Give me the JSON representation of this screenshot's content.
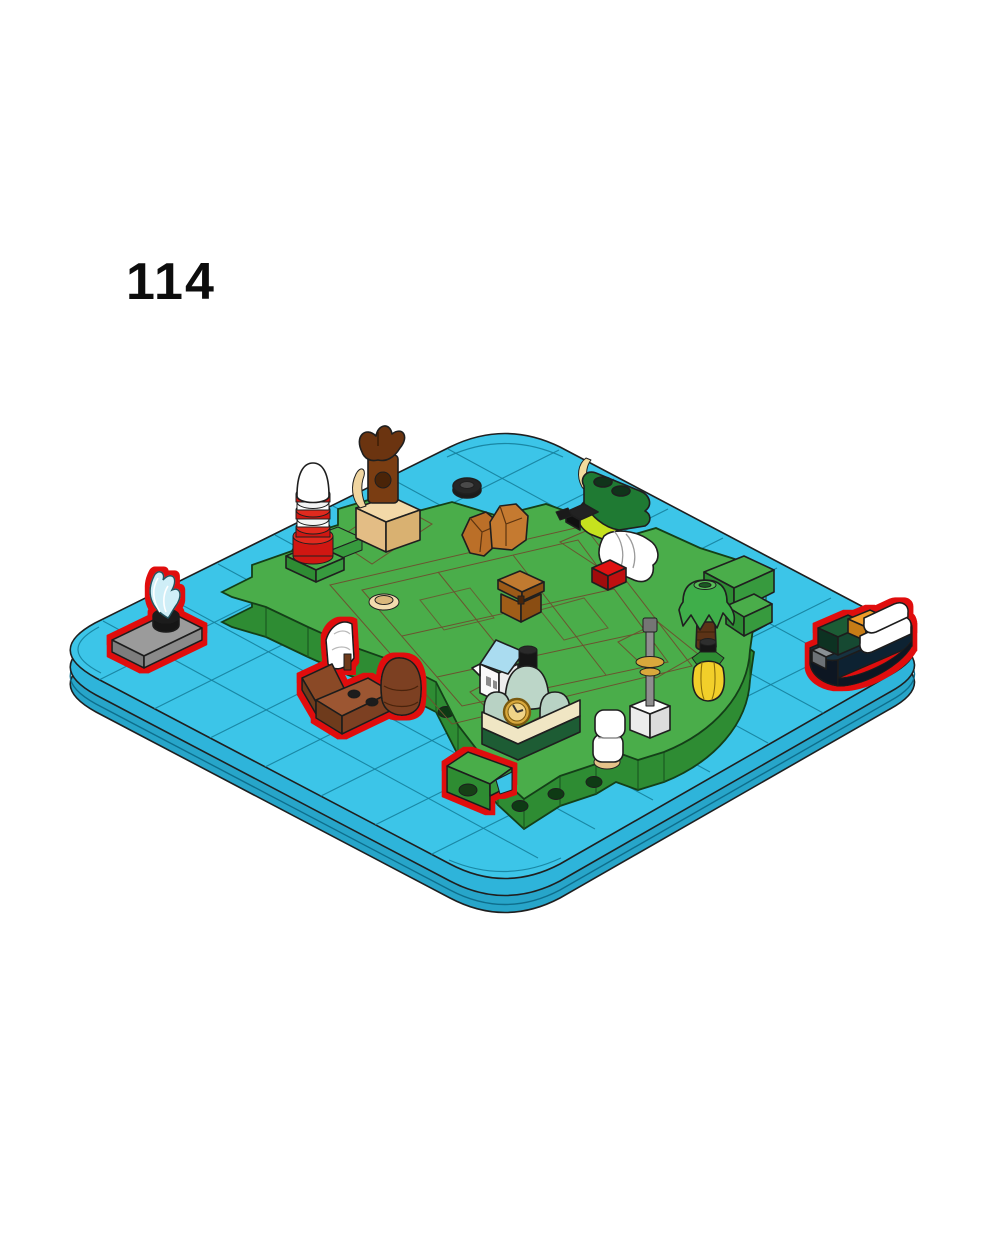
{
  "page": {
    "step_number": "114",
    "background": "#ffffff"
  },
  "theme": {
    "water": "#3cc5e8",
    "water-side": "#2eb4da",
    "water-deep": "#27a5c9",
    "water-line": "#15809c",
    "island-top": "#4aad4a",
    "island-side": "#379a3e",
    "island-dark": "#2e8c33",
    "island-outline": "#143f18",
    "path-tan": "#f2dcae",
    "path-orange": "#e9a25f",
    "highlight": "#e00f0f",
    "brown": "#8a4a26",
    "dark-brown": "#6e3a1e",
    "chest-brown": "#b06a20",
    "rock-copper": "#bb6f28",
    "red": "#d01712",
    "white": "#ffffff",
    "sand-green": "#bcd6c8",
    "gold": "#d9a83c",
    "lime": "#c6e21e",
    "dark-green": "#1d5c34",
    "hull-navy": "#16303f",
    "container-orange": "#f09c2c",
    "gray": "#9b9b9b",
    "yellow": "#f2cf2a",
    "roof-blue": "#aadcf0",
    "tan-brick": "#f3d9a8",
    "black": "#161616"
  },
  "scene": {
    "type": "lego-building-instruction-step",
    "view": "isometric",
    "baseplate": {
      "shape": "rounded-square-water-plate",
      "grid_cells": 8
    },
    "island": {
      "ground": "green",
      "paths": "tan-and-orange plaza"
    },
    "parts": [
      {
        "name": "water-splash-plate",
        "desc": "gray plate with trans-blue splash element",
        "new": true
      },
      {
        "name": "lighthouse",
        "desc": "red / white striped tower with white dome",
        "new": false
      },
      {
        "name": "bird-statue",
        "desc": "dark brown bird statue on tan pedestal",
        "new": false
      },
      {
        "name": "tire-ring",
        "desc": "black tire floating in the water",
        "new": false
      },
      {
        "name": "rocks",
        "desc": "two copper rock pieces",
        "new": false
      },
      {
        "name": "treasure-chest",
        "desc": "brown chest on the plaza",
        "new": false
      },
      {
        "name": "crocodile-figure",
        "desc": "green creature with lime jaw on white rounded brick and red brick",
        "new": false
      },
      {
        "name": "palm-tree",
        "desc": "palm tree with dark brown trunk",
        "new": false
      },
      {
        "name": "yellow-pot",
        "desc": "yellow rounded container with dark green collar",
        "new": false
      },
      {
        "name": "flag-mast",
        "desc": "gray mast with gold rings on a white cube",
        "new": false
      },
      {
        "name": "white-barrels",
        "desc": "stacked white rounded bricks",
        "new": false
      },
      {
        "name": "clock-building",
        "desc": "sand-green domed building with gold clock",
        "new": false
      },
      {
        "name": "blue-roof-house",
        "desc": "white house with light blue roof",
        "new": false
      },
      {
        "name": "brown-sailboat",
        "desc": "reddish-brown boat with white sail",
        "new": true
      },
      {
        "name": "green-wedge",
        "desc": "green slope piece at the southern shore",
        "new": true
      },
      {
        "name": "cargo-ship",
        "desc": "dark hull ship with containers and white cabin",
        "new": true
      }
    ]
  }
}
